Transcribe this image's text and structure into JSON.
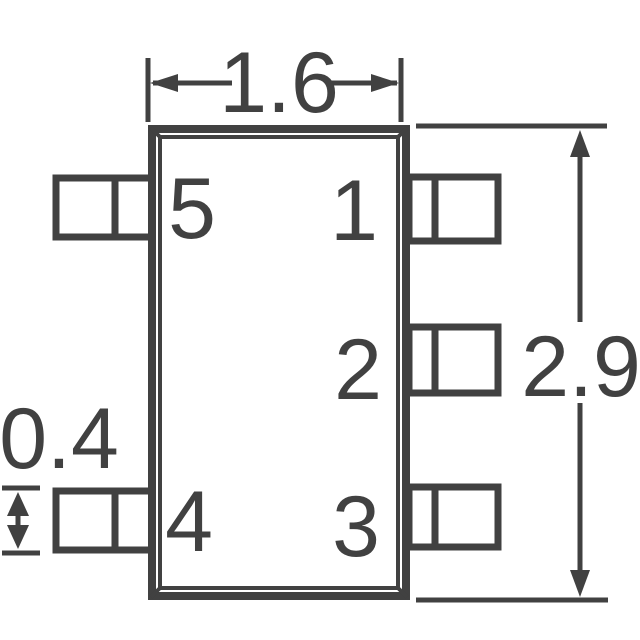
{
  "colors": {
    "line": "#414141",
    "background": "#ffffff"
  },
  "dimension_labels": {
    "body_width": "1.6",
    "overall_height": "2.9",
    "lead_width": "0.4"
  },
  "pin_labels": {
    "pin1": "1",
    "pin2": "2",
    "pin3": "3",
    "pin4": "4",
    "pin5": "5"
  }
}
